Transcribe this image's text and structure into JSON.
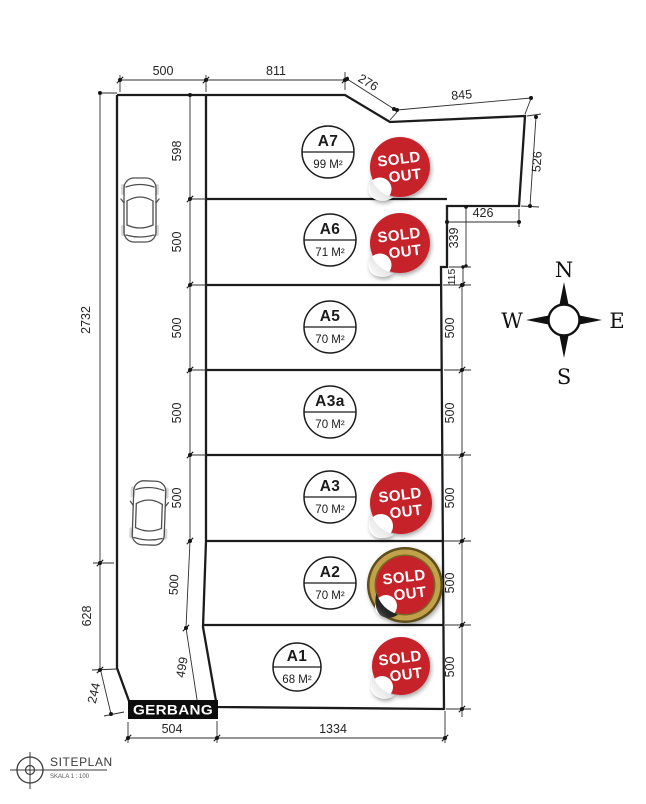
{
  "title_block": {
    "title": "SITEPLAN",
    "scale": "SKALA 1 : 100"
  },
  "gate_label": "GERBANG",
  "compass": {
    "n": "N",
    "e": "E",
    "s": "S",
    "w": "W"
  },
  "badge": {
    "line1": "SOLD",
    "line2": "OUT"
  },
  "plots": [
    {
      "id": "A7",
      "area": "99 M²",
      "status": "sold"
    },
    {
      "id": "A6",
      "area": "71 M²",
      "status": "sold"
    },
    {
      "id": "A5",
      "area": "70 M²",
      "status": "available"
    },
    {
      "id": "A3a",
      "area": "70 M²",
      "status": "available"
    },
    {
      "id": "A3",
      "area": "70 M²",
      "status": "sold"
    },
    {
      "id": "A2",
      "area": "70 M²",
      "status": "sold-gold-ring"
    },
    {
      "id": "A1",
      "area": "68 M²",
      "status": "sold"
    }
  ],
  "dims": {
    "top": [
      "500",
      "811",
      "276",
      "845"
    ],
    "right": [
      "526",
      "426",
      "339",
      "115",
      "500",
      "500",
      "500",
      "500",
      "500"
    ],
    "left_inner": [
      "598",
      "500",
      "500",
      "500",
      "500",
      "500",
      "499"
    ],
    "left_outer": [
      "2732",
      "628",
      "244"
    ],
    "bottom": [
      "504",
      "1334"
    ]
  },
  "colors": {
    "sold_red": "#c5242c",
    "gold": "#c2a14b",
    "gate_black": "#0d0d0d"
  }
}
